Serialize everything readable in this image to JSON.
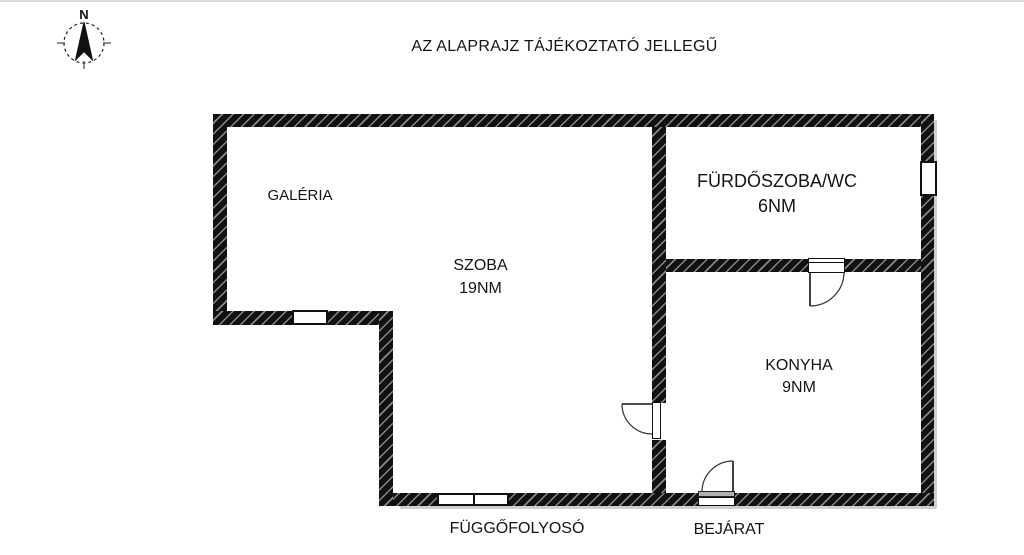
{
  "title": "AZ ALAPRAJZ TÁJÉKOZTATÓ JELLEGŰ",
  "compass": {
    "north_label": "N"
  },
  "rooms": {
    "galeria": {
      "name": "GALÉRIA"
    },
    "szoba": {
      "name": "SZOBA",
      "area": "19NM"
    },
    "furdoszoba": {
      "name": "FÜRDŐSZOBA/WC",
      "area": "6NM"
    },
    "konyha": {
      "name": "KONYHA",
      "area": "9NM"
    }
  },
  "labels": {
    "corridor": "FÜGGŐFOLYOSÓ",
    "entrance": "BEJÁRAT"
  },
  "colors": {
    "wall": "#111111",
    "background": "#ffffff",
    "text": "#141414"
  }
}
